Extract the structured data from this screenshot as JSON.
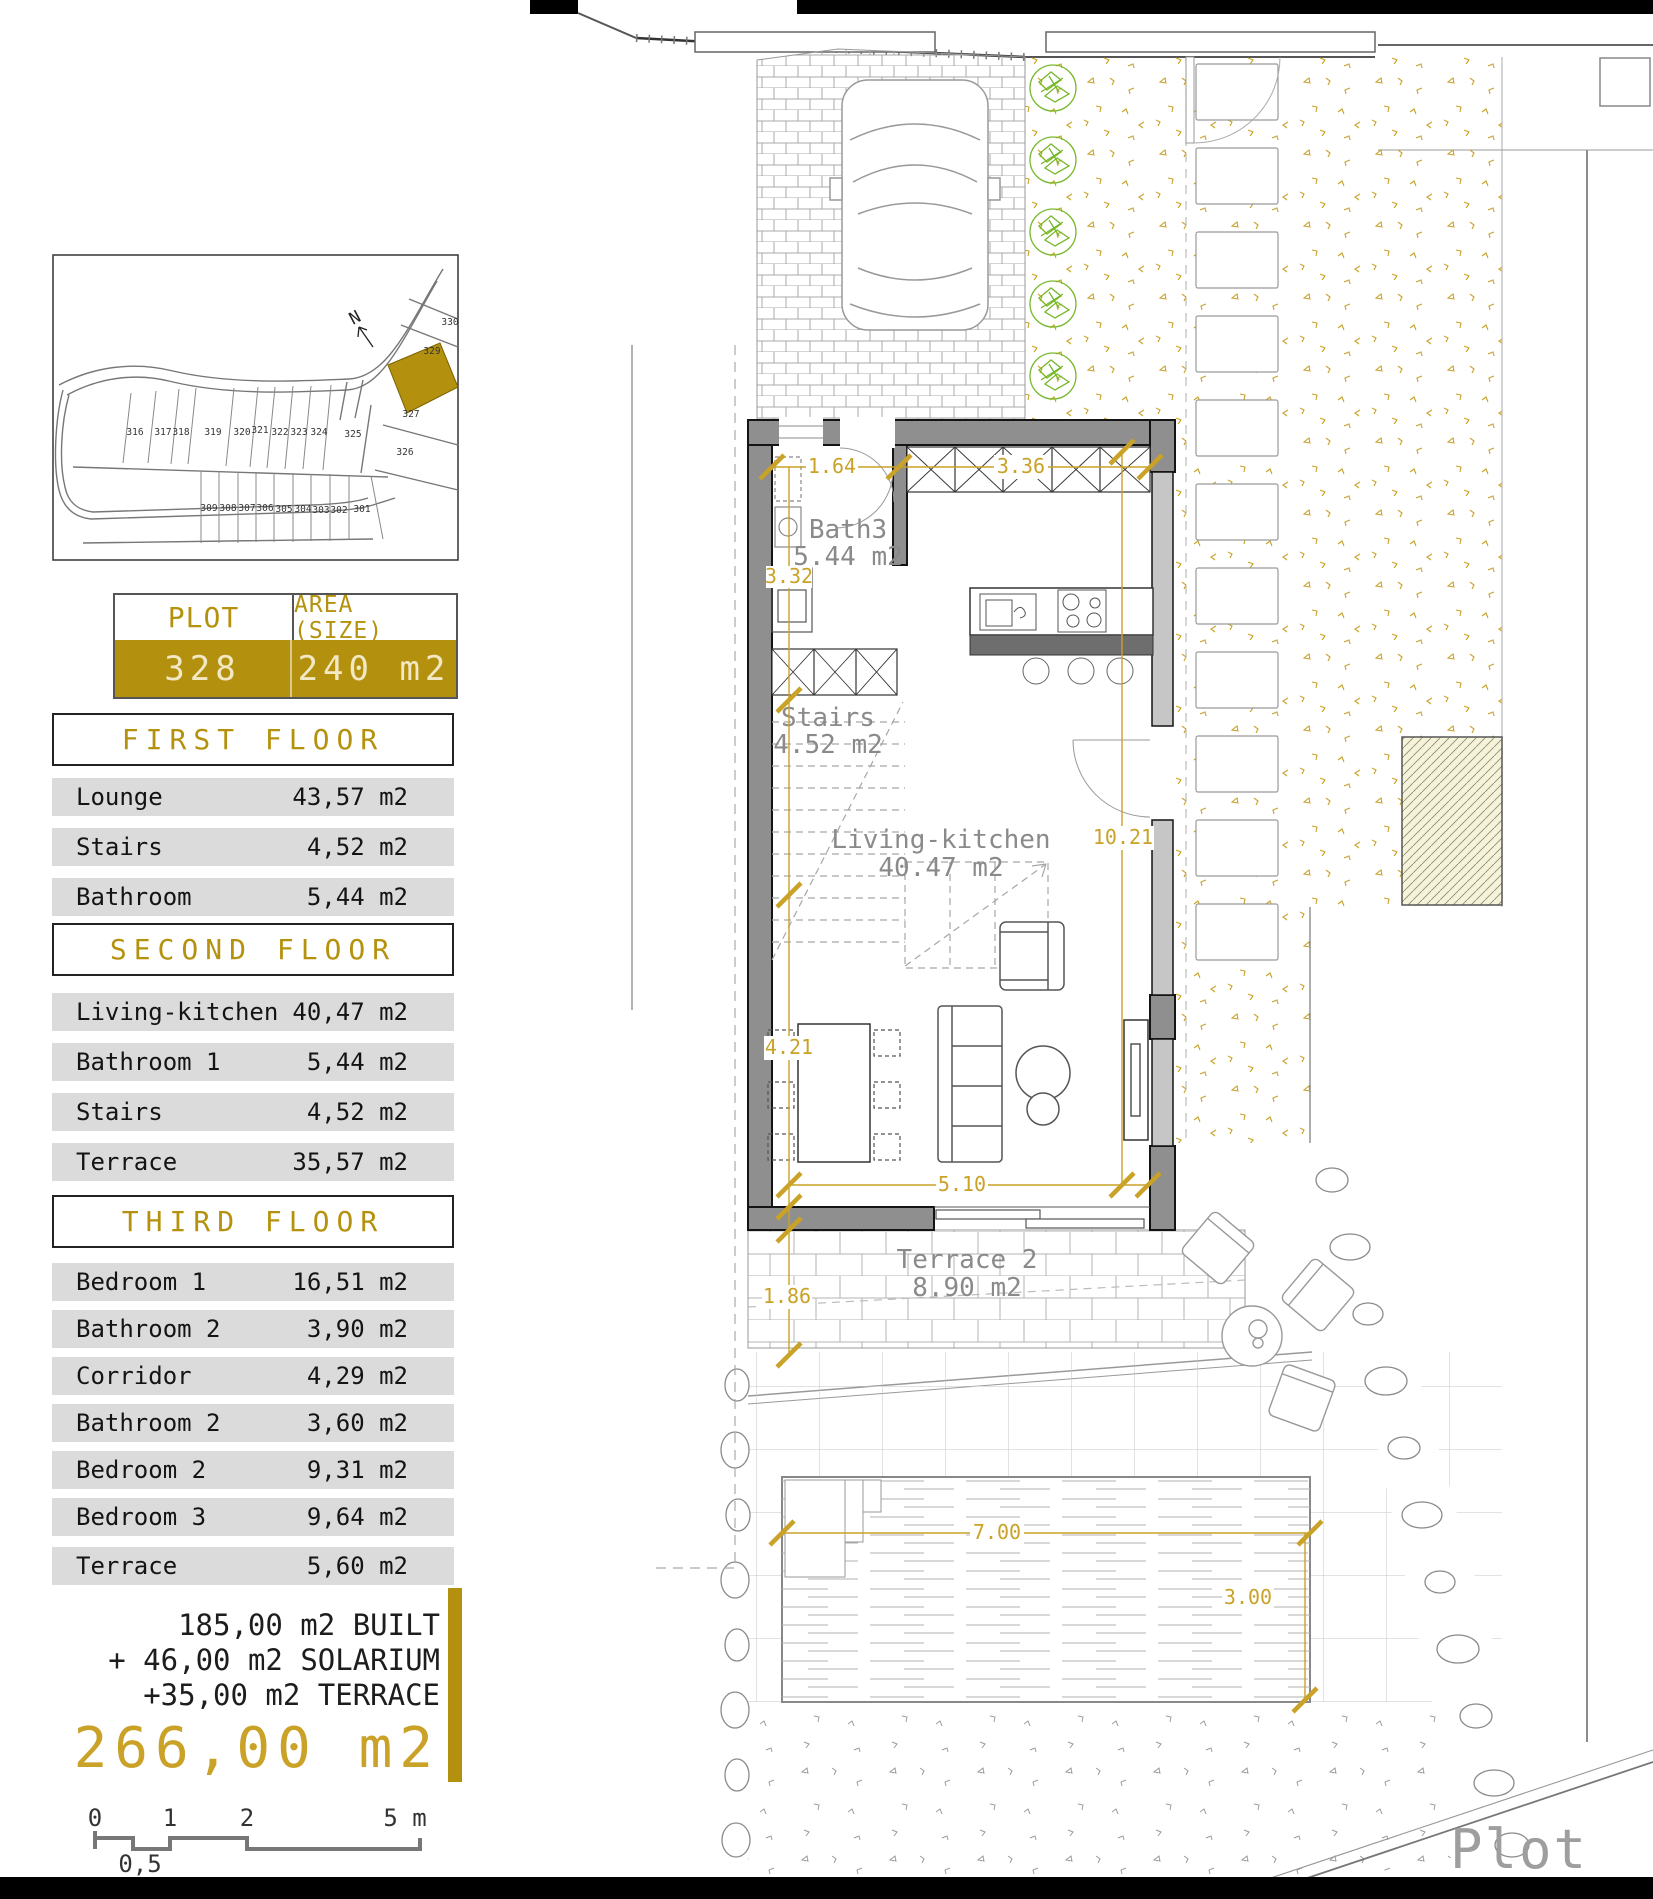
{
  "colors": {
    "accent_gold": "#B3910E",
    "dim_gold": "#C9A227",
    "row_gray": "#DBDBDB",
    "wall_gray": "#8F8F8F",
    "bush_green": "#76B82A"
  },
  "site_map": {
    "north": "N",
    "row1": [
      "316",
      "317",
      "318",
      "319",
      "320",
      "321",
      "322",
      "323",
      "324",
      "325"
    ],
    "row2": [
      "309",
      "308",
      "307",
      "306",
      "305",
      "304",
      "303",
      "302",
      "301"
    ],
    "right": [
      "330",
      "329",
      "327",
      "326"
    ]
  },
  "plot_table": {
    "header_plot": "PLOT",
    "header_area": "AREA (SIZE)",
    "plot_number": "328",
    "plot_area": "240 m2"
  },
  "floors": [
    {
      "title": "FIRST FLOOR",
      "rows": [
        {
          "label": "Lounge",
          "area": "43,57 m2"
        },
        {
          "label": "Stairs",
          "area": "4,52 m2"
        },
        {
          "label": "Bathroom",
          "area": "5,44 m2"
        }
      ]
    },
    {
      "title": "SECOND FLOOR",
      "rows": [
        {
          "label": "Living-kitchen",
          "area": "40,47 m2"
        },
        {
          "label": "Bathroom 1",
          "area": "5,44 m2"
        },
        {
          "label": "Stairs",
          "area": "4,52 m2"
        },
        {
          "label": "Terrace",
          "area": "35,57 m2"
        }
      ]
    },
    {
      "title": "THIRD FLOOR",
      "rows": [
        {
          "label": "Bedroom 1",
          "area": "16,51 m2"
        },
        {
          "label": "Bathroom 2",
          "area": "3,90 m2"
        },
        {
          "label": "Corridor",
          "area": "4,29 m2"
        },
        {
          "label": "Bathroom 2",
          "area": "3,60 m2"
        },
        {
          "label": "Bedroom 2",
          "area": "9,31 m2"
        },
        {
          "label": "Bedroom 3",
          "area": "9,64 m2"
        },
        {
          "label": "Terrace",
          "area": "5,60 m2"
        }
      ]
    }
  ],
  "summary": {
    "built": "185,00 m2 BUILT",
    "solarium": "+ 46,00 m2 SOLARIUM",
    "terrace": "+35,00 m2 TERRACE",
    "total": "266,00 m2"
  },
  "scale_bar": {
    "zero": "0",
    "one": "1",
    "two": "2",
    "five": "5 m",
    "half": "0,5"
  },
  "plan": {
    "labels": {
      "bath3": "Bath3",
      "bath3_area": "5.44 m2",
      "stairs": "Stairs",
      "stairs_area": "4.52 m2",
      "living": "Living-kitchen",
      "living_area": "40.47 m2",
      "terrace2": "Terrace 2",
      "terrace2_area": "8.90 m2",
      "plot": "Plot"
    },
    "dimensions": {
      "entry": "1.64",
      "wardr": "3.36",
      "bathd": "3.32",
      "length": "10.21",
      "dining": "4.21",
      "width": "5.10",
      "terrd": "1.86",
      "pooll": "7.00",
      "poolw": "3.00"
    }
  }
}
